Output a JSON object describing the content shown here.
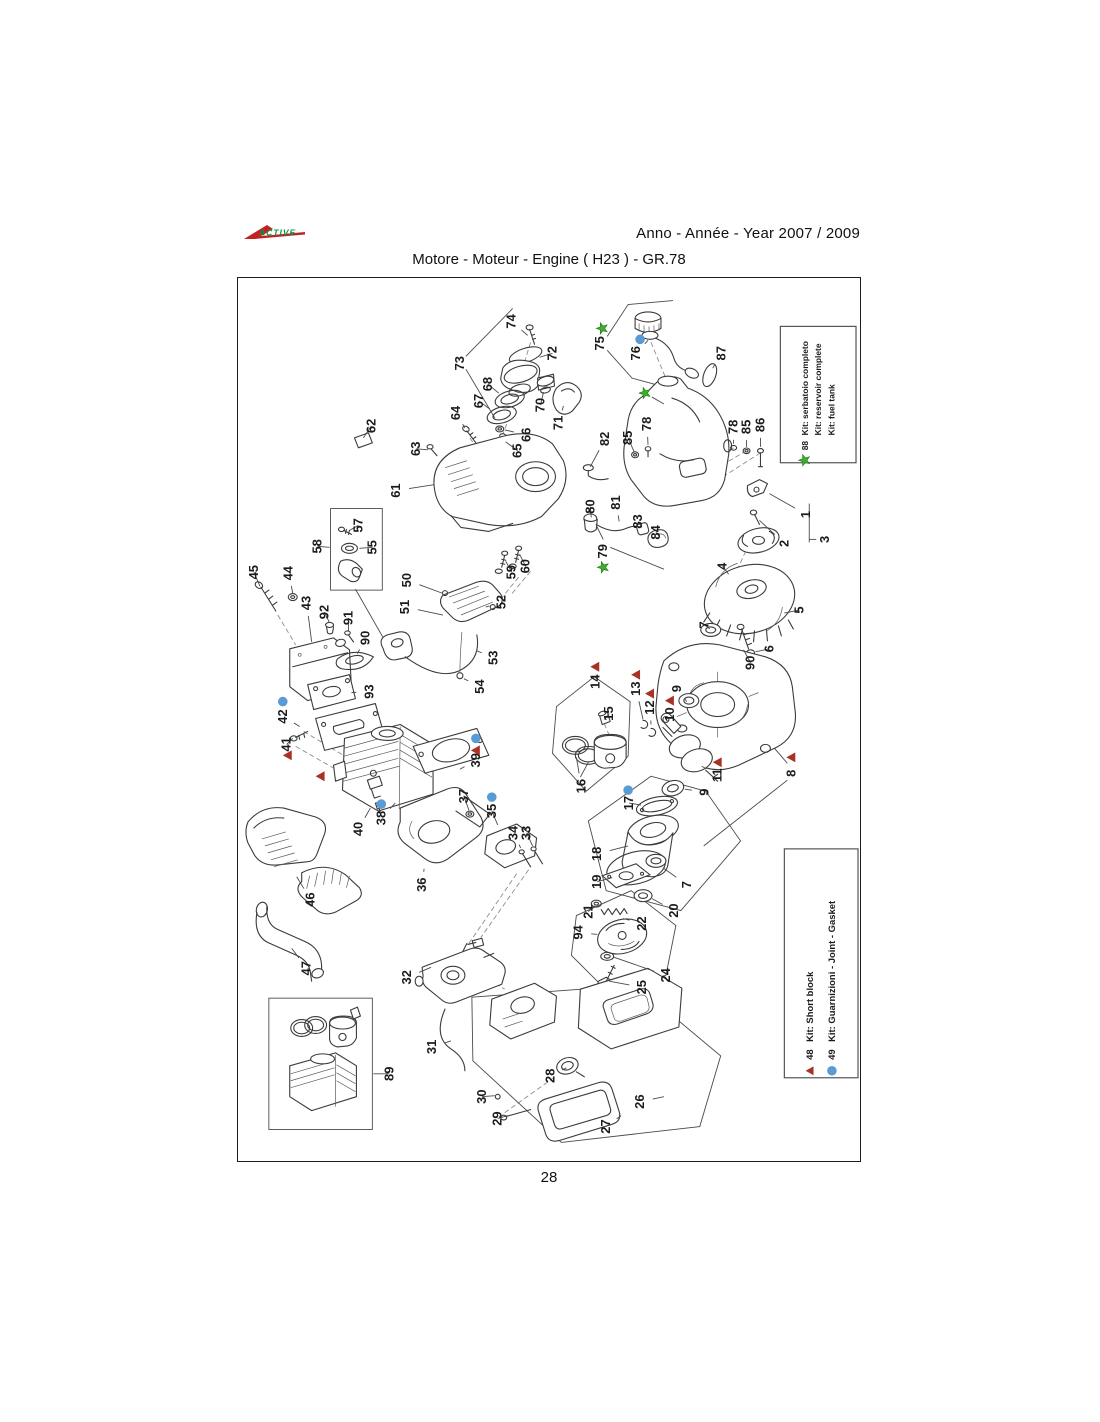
{
  "header": {
    "logo_text": "ACTIVE",
    "year_label": "Anno - Année - Year  2007 / 2009",
    "title": "Motore - Moteur - Engine ( H23 )  -  GR.78"
  },
  "page_number": "28",
  "colors": {
    "kit_triangle": "#a93226",
    "kit_circle": "#5b9bd5",
    "kit_star": "#3fae2e",
    "logo_red": "#c42127",
    "logo_green": "#00963f"
  },
  "legends": {
    "fuel_tank_kit": {
      "lines": [
        {
          "marker": "star",
          "number": "88",
          "text": "Kit: serbatoio completo"
        },
        {
          "text": "Kit: reservoir complete"
        },
        {
          "text": "Kit: fuel tank"
        }
      ]
    },
    "parts_kits": {
      "lines": [
        {
          "marker": "tri",
          "number": "48",
          "text": "Kit: Short block"
        },
        {
          "marker": "dot",
          "number": "49",
          "text": "Kit: Guarnizioni - Joint - Gasket"
        }
      ]
    }
  },
  "diagram": {
    "part_labels": [
      {
        "n": "74",
        "x": 275,
        "y": 43,
        "lx": 291,
        "ly": 57
      },
      {
        "n": "73",
        "x": 223,
        "y": 85
      },
      {
        "n": "72",
        "x": 316,
        "y": 75,
        "lx": 303,
        "ly": 79
      },
      {
        "n": "68",
        "x": 251,
        "y": 106,
        "lx": 262,
        "ly": 115
      },
      {
        "n": "67",
        "x": 242,
        "y": 123,
        "lx": 253,
        "ly": 131
      },
      {
        "n": "70",
        "x": 304,
        "y": 127,
        "lx": 307,
        "ly": 114
      },
      {
        "n": "71",
        "x": 322,
        "y": 145,
        "lx": 327,
        "ly": 128
      },
      {
        "n": "64",
        "x": 219,
        "y": 135,
        "lx": 228,
        "ly": 150
      },
      {
        "n": "66",
        "x": 290,
        "y": 157,
        "lx": 268,
        "ly": 152
      },
      {
        "n": "65",
        "x": 281,
        "y": 173,
        "lx": 269,
        "ly": 164
      },
      {
        "n": "62",
        "x": 134,
        "y": 148,
        "lx": 126,
        "ly": 160
      },
      {
        "n": "63",
        "x": 179,
        "y": 171,
        "lx": 191,
        "ly": 172
      },
      {
        "n": "61",
        "x": 159,
        "y": 213,
        "lx": 197,
        "ly": 207
      },
      {
        "n": "75",
        "x": 364,
        "y": 65
      },
      {
        "n": "76",
        "x": 400,
        "y": 75,
        "lx": 412,
        "ly": 62
      },
      {
        "n": "87",
        "x": 486,
        "y": 75,
        "lx": 477,
        "ly": 90
      },
      {
        "n": "82",
        "x": 369,
        "y": 161,
        "lx": 354,
        "ly": 189
      },
      {
        "n": "85",
        "x": 392,
        "y": 160,
        "lx": 398,
        "ly": 174
      },
      {
        "n": "78",
        "x": 411,
        "y": 146,
        "lx": 412,
        "ly": 167
      },
      {
        "n": "78",
        "x": 498,
        "y": 149,
        "lx": 498,
        "ly": 166
      },
      {
        "n": "85",
        "x": 511,
        "y": 149,
        "lx": 511,
        "ly": 169
      },
      {
        "n": "86",
        "x": 525,
        "y": 147,
        "lx": 525,
        "ly": 169
      },
      {
        "n": "80",
        "x": 354,
        "y": 229,
        "lx": 355,
        "ly": 240
      },
      {
        "n": "81",
        "x": 380,
        "y": 225,
        "lx": 383,
        "ly": 244
      },
      {
        "n": "83",
        "x": 402,
        "y": 244,
        "lx": 406,
        "ly": 250
      },
      {
        "n": "84",
        "x": 420,
        "y": 255,
        "lx": 424,
        "ly": 260
      },
      {
        "n": "79",
        "x": 367,
        "y": 274
      },
      {
        "n": "1",
        "x": 571,
        "y": 237,
        "lx": 534,
        "ly": 216
      },
      {
        "n": "2",
        "x": 549,
        "y": 266,
        "lx": 524,
        "ly": 243
      },
      {
        "n": "3",
        "x": 590,
        "y": 262
      },
      {
        "n": "4",
        "x": 487,
        "y": 289,
        "lx": 493,
        "ly": 297
      },
      {
        "n": "5",
        "x": 564,
        "y": 333,
        "lx": 549,
        "ly": 336
      },
      {
        "n": "7",
        "x": 469,
        "y": 348,
        "lx": 474,
        "ly": 352
      },
      {
        "n": "6",
        "x": 534,
        "y": 372,
        "lx": 520,
        "ly": 375
      },
      {
        "n": "90",
        "x": 515,
        "y": 386,
        "lx": 508,
        "ly": 373
      },
      {
        "n": "9",
        "x": 441,
        "y": 412,
        "lx": 451,
        "ly": 425
      },
      {
        "n": "14",
        "x": 359,
        "y": 405
      },
      {
        "n": "15",
        "x": 373,
        "y": 437,
        "lx": 368,
        "ly": 443
      },
      {
        "n": "13",
        "x": 400,
        "y": 412,
        "lx": 407,
        "ly": 443
      },
      {
        "n": "12",
        "x": 414,
        "y": 431,
        "lx": 415,
        "ly": 448
      },
      {
        "n": "10",
        "x": 434,
        "y": 438,
        "lx": 444,
        "ly": 449
      },
      {
        "n": "16",
        "x": 345,
        "y": 510,
        "lx": 340,
        "ly": 481
      },
      {
        "n": "11",
        "x": 482,
        "y": 499,
        "lx": 466,
        "ly": 490
      },
      {
        "n": "8",
        "x": 556,
        "y": 497
      },
      {
        "n": "9",
        "x": 469,
        "y": 516,
        "lx": 449,
        "ly": 513
      },
      {
        "n": "17",
        "x": 393,
        "y": 527,
        "lx": 405,
        "ly": 529
      },
      {
        "n": "18",
        "x": 361,
        "y": 578,
        "lx": 392,
        "ly": 570
      },
      {
        "n": "19",
        "x": 361,
        "y": 606,
        "lx": 376,
        "ly": 602
      },
      {
        "n": "7",
        "x": 451,
        "y": 609,
        "lx": 427,
        "ly": 592
      },
      {
        "n": "20",
        "x": 438,
        "y": 635,
        "lx": 416,
        "ly": 623
      },
      {
        "n": "21",
        "x": 352,
        "y": 636,
        "lx": 359,
        "ly": 630
      },
      {
        "n": "22",
        "x": 406,
        "y": 648,
        "lx": 387,
        "ly": 643
      },
      {
        "n": "94",
        "x": 342,
        "y": 657,
        "lx": 361,
        "ly": 659
      },
      {
        "n": "24",
        "x": 430,
        "y": 700,
        "lx": 378,
        "ly": 682
      },
      {
        "n": "25",
        "x": 406,
        "y": 712,
        "lx": 373,
        "ly": 706
      },
      {
        "n": "45",
        "x": 16,
        "y": 295,
        "lx": 22,
        "ly": 309
      },
      {
        "n": "44",
        "x": 51,
        "y": 296,
        "lx": 55,
        "ly": 316
      },
      {
        "n": "43",
        "x": 69,
        "y": 326,
        "lx": 74,
        "ly": 365
      },
      {
        "n": "92",
        "x": 87,
        "y": 335,
        "lx": 92,
        "ly": 346
      },
      {
        "n": "91",
        "x": 111,
        "y": 341,
        "lx": 111,
        "ly": 354
      },
      {
        "n": "90",
        "x": 128,
        "y": 361,
        "lx": 120,
        "ly": 377
      },
      {
        "n": "93",
        "x": 132,
        "y": 415,
        "lx": 114,
        "ly": 416
      },
      {
        "n": "42",
        "x": 45,
        "y": 440,
        "lx": 62,
        "ly": 450
      },
      {
        "n": "41",
        "x": 49,
        "y": 468,
        "lx": 55,
        "ly": 462
      },
      {
        "n": "57",
        "x": 121,
        "y": 248,
        "lx": 112,
        "ly": 253
      },
      {
        "n": "55",
        "x": 135,
        "y": 270,
        "lx": 122,
        "ly": 271
      },
      {
        "n": "58",
        "x": 80,
        "y": 269,
        "lx": 92,
        "ly": 270
      },
      {
        "n": "50",
        "x": 170,
        "y": 303,
        "lx": 205,
        "ly": 316
      },
      {
        "n": "51",
        "x": 168,
        "y": 330,
        "lx": 206,
        "ly": 338
      },
      {
        "n": "60",
        "x": 289,
        "y": 289,
        "lx": 283,
        "ly": 277
      },
      {
        "n": "59",
        "x": 275,
        "y": 295,
        "lx": 269,
        "ly": 284
      },
      {
        "n": "52",
        "x": 265,
        "y": 325,
        "lx": 249,
        "ly": 330
      },
      {
        "n": "53",
        "x": 257,
        "y": 381,
        "lx": 240,
        "ly": 374
      },
      {
        "n": "54",
        "x": 243,
        "y": 410,
        "lx": 227,
        "ly": 402
      },
      {
        "n": "40",
        "x": 121,
        "y": 553,
        "lx": 133,
        "ly": 532
      },
      {
        "n": "38",
        "x": 144,
        "y": 542,
        "lx": 158,
        "ly": 527
      },
      {
        "n": "39",
        "x": 239,
        "y": 484,
        "lx": 223,
        "ly": 493
      },
      {
        "n": "37",
        "x": 227,
        "y": 520,
        "lx": 232,
        "ly": 534
      },
      {
        "n": "35",
        "x": 255,
        "y": 535,
        "lx": 261,
        "ly": 549
      },
      {
        "n": "34",
        "x": 277,
        "y": 557,
        "lx": 284,
        "ly": 572
      },
      {
        "n": "33",
        "x": 290,
        "y": 557,
        "lx": 296,
        "ly": 570
      },
      {
        "n": "36",
        "x": 185,
        "y": 609,
        "lx": 187,
        "ly": 593
      },
      {
        "n": "46",
        "x": 73,
        "y": 624,
        "lx": 59,
        "ly": 601
      },
      {
        "n": "47",
        "x": 69,
        "y": 693,
        "lx": 54,
        "ly": 673
      },
      {
        "n": "32",
        "x": 170,
        "y": 702,
        "lx": 194,
        "ly": 692
      },
      {
        "n": "31",
        "x": 195,
        "y": 772,
        "lx": 214,
        "ly": 766
      },
      {
        "n": "89",
        "x": 152,
        "y": 799,
        "lx": 136,
        "ly": 799
      },
      {
        "n": "30",
        "x": 245,
        "y": 822,
        "lx": 258,
        "ly": 821
      },
      {
        "n": "29",
        "x": 261,
        "y": 844,
        "lx": 271,
        "ly": 841
      },
      {
        "n": "28",
        "x": 314,
        "y": 801,
        "lx": 330,
        "ly": 793
      },
      {
        "n": "27",
        "x": 370,
        "y": 852,
        "lx": 385,
        "ly": 841
      },
      {
        "n": "26",
        "x": 404,
        "y": 827,
        "lx": 428,
        "ly": 822
      }
    ],
    "markers": [
      {
        "t": "star",
        "x": 366,
        "y": 50
      },
      {
        "t": "dot",
        "x": 404,
        "y": 61
      },
      {
        "t": "star",
        "x": 409,
        "y": 115,
        "lx": 428,
        "ly": 126
      },
      {
        "t": "star",
        "x": 367,
        "y": 290
      },
      {
        "t": "tri",
        "x": 359,
        "y": 390
      },
      {
        "t": "tri",
        "x": 400,
        "y": 398
      },
      {
        "t": "tri",
        "x": 414,
        "y": 417
      },
      {
        "t": "tri",
        "x": 434,
        "y": 424
      },
      {
        "t": "tri",
        "x": 482,
        "y": 486
      },
      {
        "t": "tri",
        "x": 556,
        "y": 481
      },
      {
        "t": "dot",
        "x": 45,
        "y": 425
      },
      {
        "t": "tri",
        "x": 50,
        "y": 479
      },
      {
        "t": "tri",
        "x": 83,
        "y": 500
      },
      {
        "t": "dot",
        "x": 144,
        "y": 528
      },
      {
        "t": "dot",
        "x": 239,
        "y": 462
      },
      {
        "t": "tri",
        "x": 239,
        "y": 474
      },
      {
        "t": "dot",
        "x": 255,
        "y": 521
      },
      {
        "t": "dot",
        "x": 392,
        "y": 514
      }
    ]
  }
}
